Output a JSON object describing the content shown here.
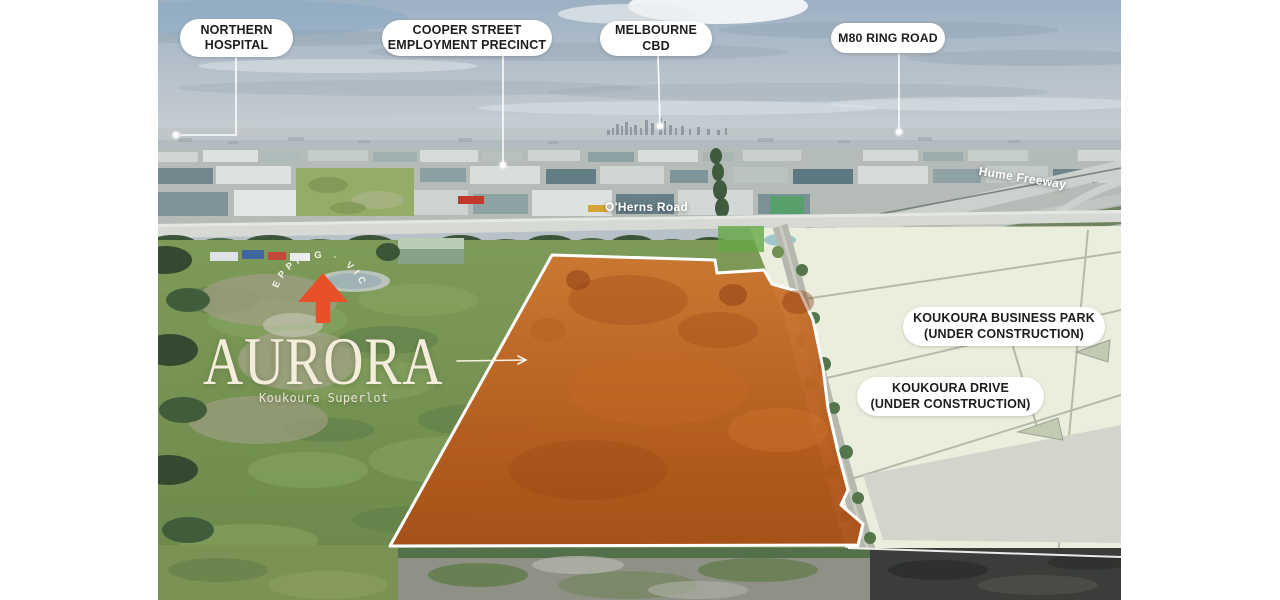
{
  "callouts": {
    "northern": [
      "NORTHERN",
      "HOSPITAL"
    ],
    "cooper": [
      "COOPER STREET",
      "EMPLOYMENT PRECINCT"
    ],
    "melbourne": [
      "MELBOURNE",
      "CBD"
    ],
    "m80": [
      "M80 RING ROAD"
    ],
    "business_park": [
      "KOUKOURA BUSINESS PARK",
      "(UNDER CONSTRUCTION)"
    ],
    "drive": [
      "KOUKOURA DRIVE",
      "(UNDER CONSTRUCTION)"
    ]
  },
  "roads": {
    "oherns": "O'Herns Road",
    "hume": "Hume Freeway"
  },
  "brand": {
    "name": "AURORA",
    "tagline": "Koukoura Superlot",
    "arc_text": "EPPING · VIC"
  },
  "colors": {
    "accent_orange": "#E8502A",
    "parcel_orange": "#BE5A1E",
    "pill_bg": "#FFFFFF",
    "pill_text": "#1D1D1F",
    "brand_cream": "#F4EDDC"
  }
}
